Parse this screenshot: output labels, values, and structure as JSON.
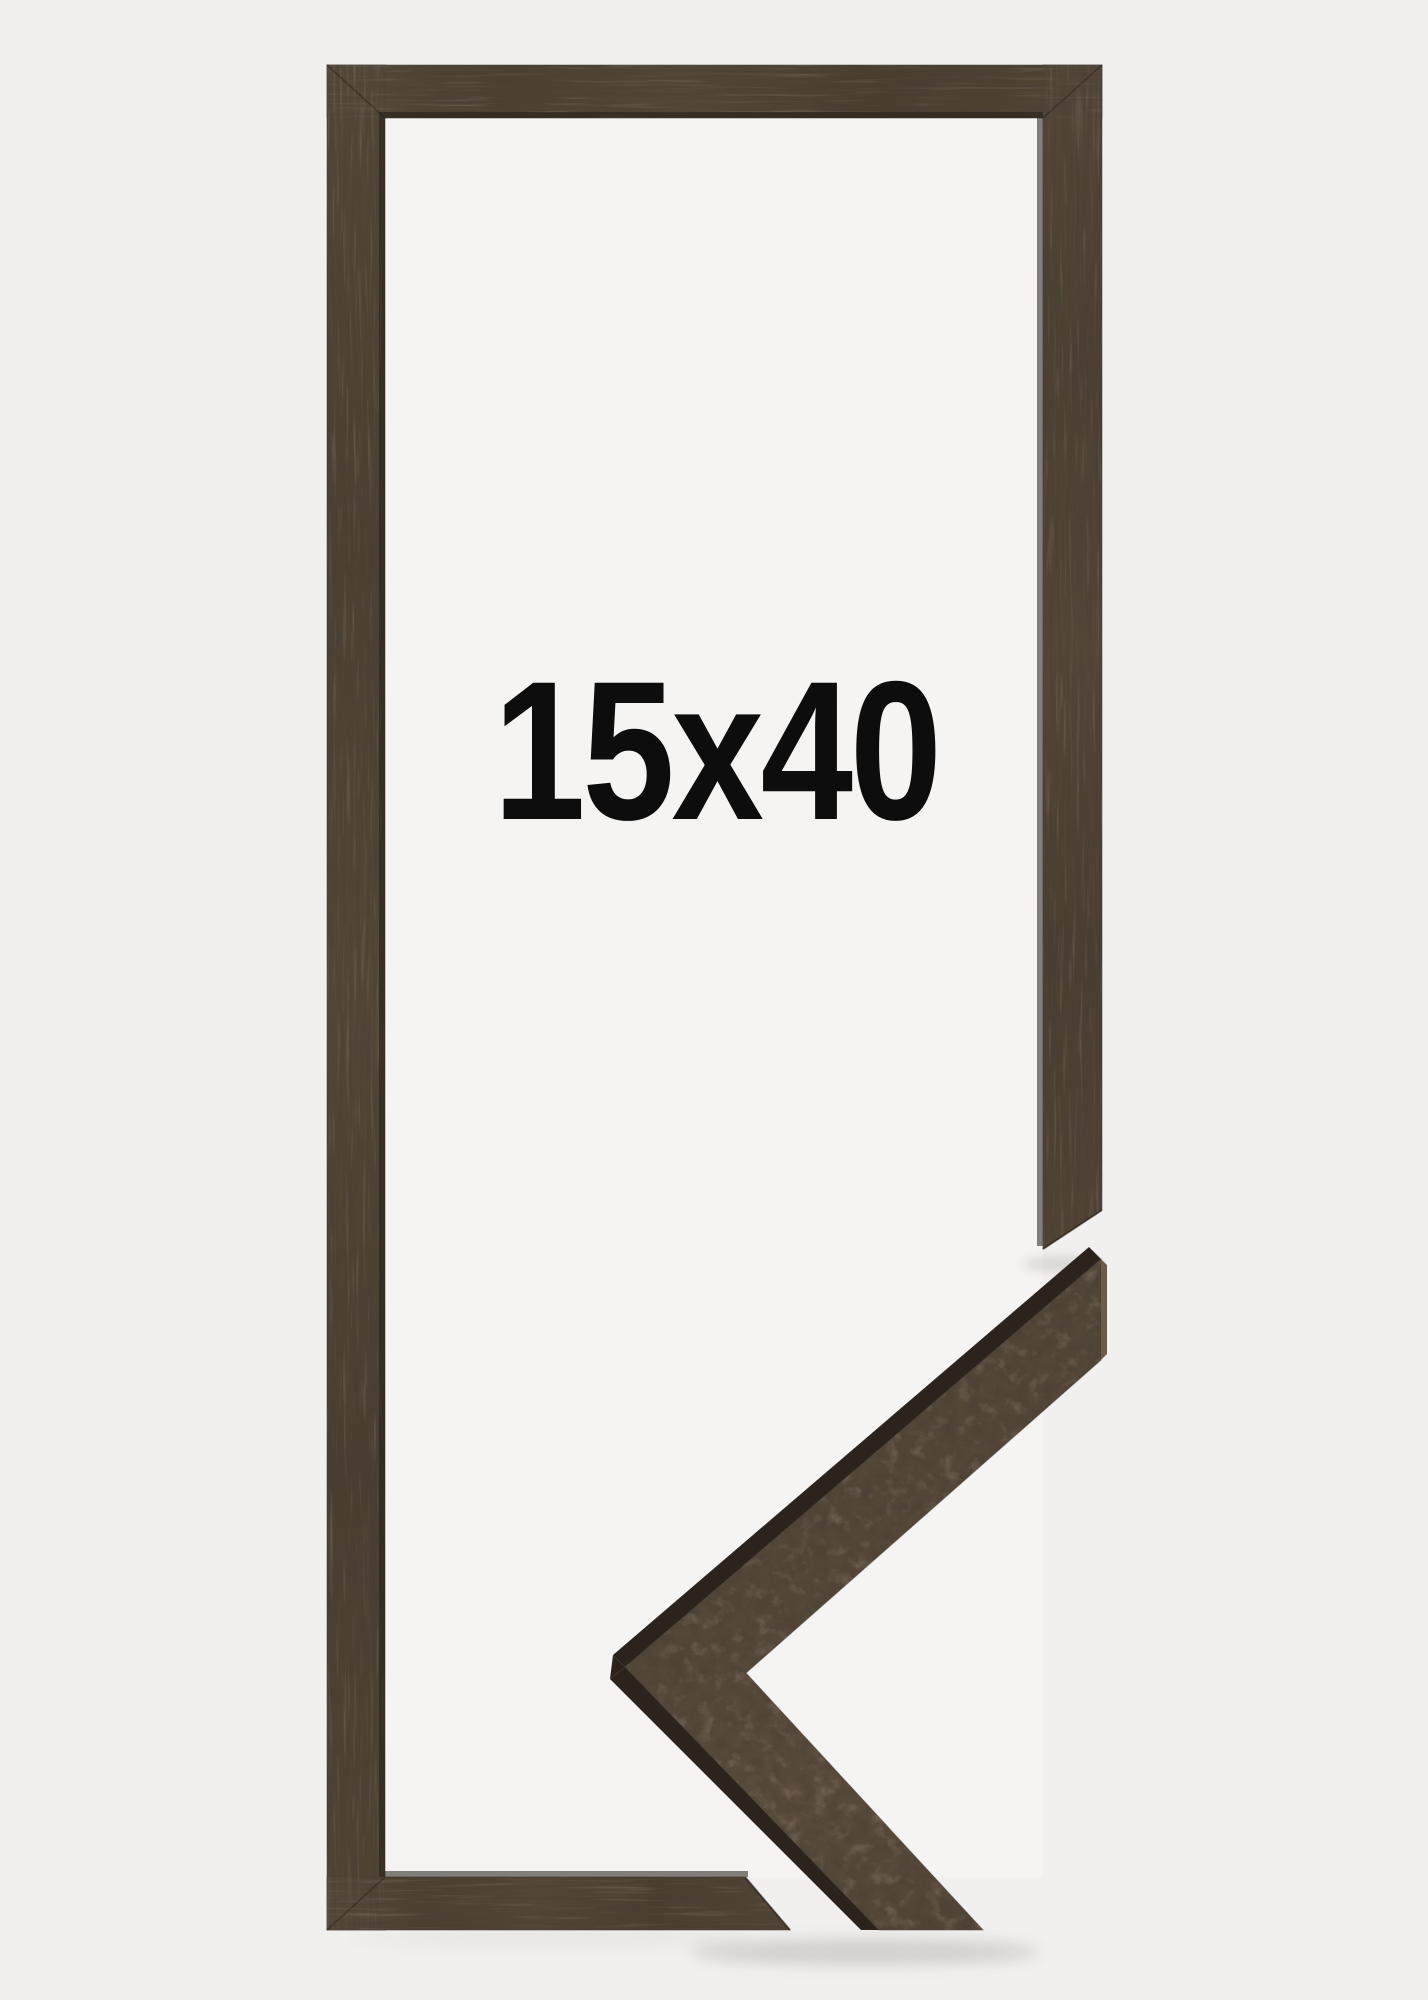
{
  "product": {
    "size_label": "15x40",
    "description": "wooden picture frame with mitred corner sample"
  },
  "colors": {
    "background": "#f1f0ee",
    "interior": "#f5f4f2",
    "wood_base": "#4f4233",
    "wood_mid": "#57493a",
    "wood_flank": "#2b231c",
    "wood_light_edge": "#6e5c49",
    "rabbet_shadow": "#241d16",
    "text": "#0d0d0d"
  }
}
